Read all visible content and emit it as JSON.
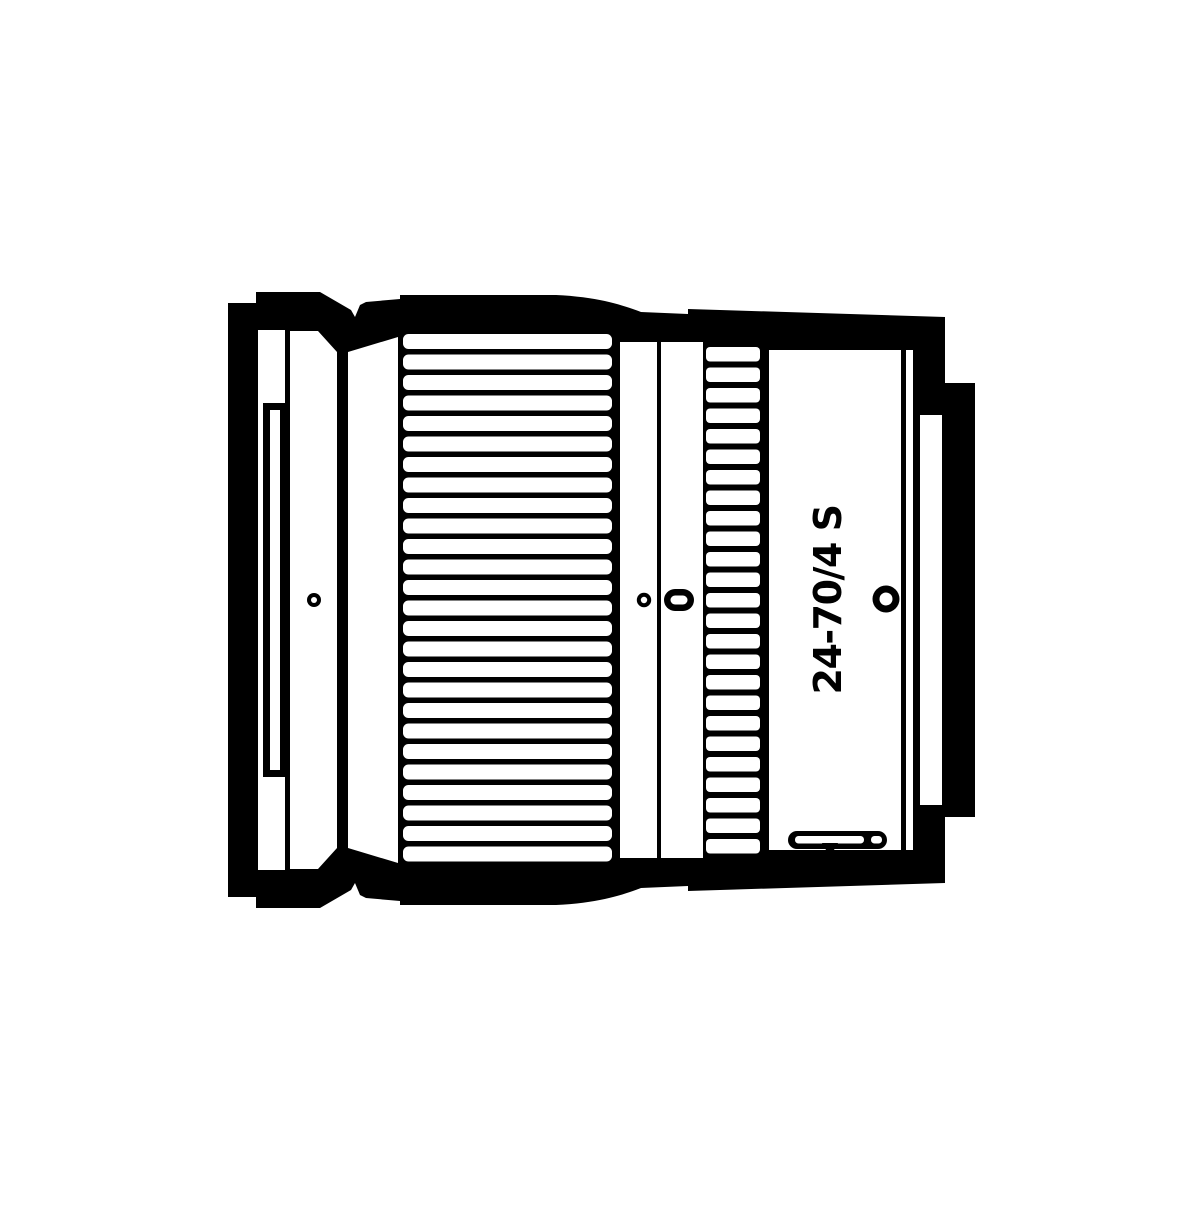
{
  "diagram": {
    "label": "24-70/4 S",
    "ink_color": "#000000",
    "paper_color": "#ffffff",
    "zoom_ring": {
      "rib_count": 26
    },
    "control_ring": {
      "rib_count": 25
    }
  }
}
